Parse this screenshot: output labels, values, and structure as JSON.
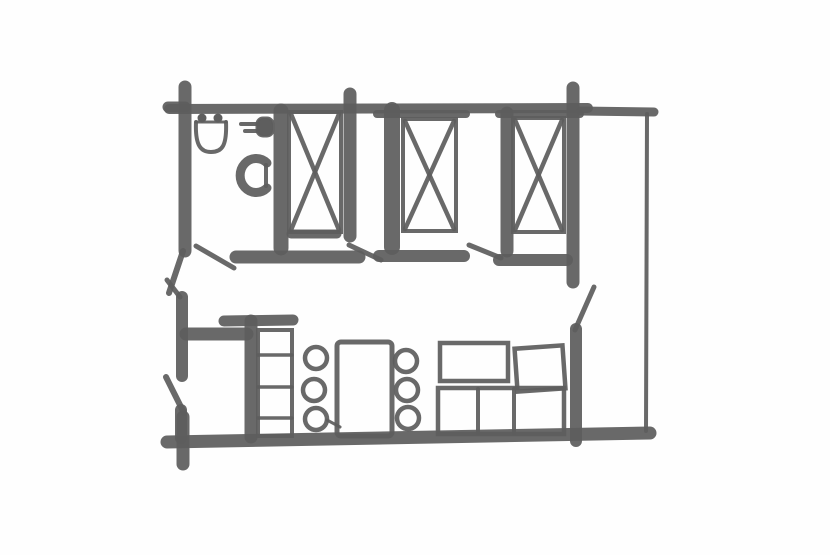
{
  "canvas": {
    "w": 830,
    "h": 555,
    "bg": "#fefefe",
    "ink": "#5e5e5e"
  },
  "floorplan": {
    "kind": "hand-drawn-floor-plan-sketch",
    "shapes": [
      {
        "name": "top-wall",
        "type": "line",
        "x1": 169,
        "y1": 109,
        "x2": 588,
        "y2": 108,
        "sw": 10
      },
      {
        "name": "top-wall-right",
        "type": "line",
        "x1": 580,
        "y1": 111,
        "x2": 654,
        "y2": 112,
        "sw": 9
      },
      {
        "name": "top-wall-cap-room2",
        "type": "line",
        "x1": 377,
        "y1": 114,
        "x2": 466,
        "y2": 114,
        "sw": 8
      },
      {
        "name": "top-wall-cap-room3",
        "type": "line",
        "x1": 499,
        "y1": 114,
        "x2": 580,
        "y2": 114,
        "sw": 8
      },
      {
        "name": "left-wall-upper",
        "type": "line",
        "x1": 185,
        "y1": 87,
        "x2": 185,
        "y2": 251,
        "sw": 13
      },
      {
        "name": "left-wall-top-arm",
        "type": "line",
        "x1": 168,
        "y1": 107,
        "x2": 185,
        "y2": 107,
        "sw": 11
      },
      {
        "name": "left-wall-taper",
        "type": "line",
        "x1": 183,
        "y1": 251,
        "x2": 169,
        "y2": 293,
        "sw": 6
      },
      {
        "name": "bathroom-right-wall",
        "type": "line",
        "x1": 281,
        "y1": 111,
        "x2": 281,
        "y2": 248,
        "sw": 15
      },
      {
        "name": "corridor-wall-a",
        "type": "line",
        "x1": 236,
        "y1": 257,
        "x2": 359,
        "y2": 257,
        "sw": 13
      },
      {
        "name": "room1-right-wall",
        "type": "line",
        "x1": 350,
        "y1": 94,
        "x2": 350,
        "y2": 236,
        "sw": 13
      },
      {
        "name": "bed1-foot-bar",
        "type": "line",
        "x1": 291,
        "y1": 234,
        "x2": 337,
        "y2": 234,
        "sw": 9
      },
      {
        "name": "room2-left-wall",
        "type": "line",
        "x1": 392,
        "y1": 110,
        "x2": 392,
        "y2": 247,
        "sw": 16
      },
      {
        "name": "corridor-wall-b",
        "type": "line",
        "x1": 379,
        "y1": 256,
        "x2": 464,
        "y2": 256,
        "sw": 12
      },
      {
        "name": "room3-left-wall",
        "type": "line",
        "x1": 507,
        "y1": 113,
        "x2": 507,
        "y2": 251,
        "sw": 13
      },
      {
        "name": "corridor-wall-c",
        "type": "line",
        "x1": 499,
        "y1": 260,
        "x2": 567,
        "y2": 260,
        "sw": 12
      },
      {
        "name": "room3-right-wall",
        "type": "line",
        "x1": 573,
        "y1": 88,
        "x2": 573,
        "y2": 282,
        "sw": 13
      },
      {
        "name": "living-right-wall",
        "type": "line",
        "x1": 576,
        "y1": 329,
        "x2": 576,
        "y2": 441,
        "sw": 12
      },
      {
        "name": "bottom-wall",
        "type": "line",
        "x1": 167,
        "y1": 442,
        "x2": 650,
        "y2": 433,
        "sw": 13
      },
      {
        "name": "bottom-left-stub",
        "type": "line",
        "x1": 183,
        "y1": 417,
        "x2": 183,
        "y2": 464,
        "sw": 13
      },
      {
        "name": "left-wall-lower",
        "type": "line",
        "x1": 182,
        "y1": 297,
        "x2": 182,
        "y2": 376,
        "sw": 12
      },
      {
        "name": "left-wall-lower-2",
        "type": "line",
        "x1": 181,
        "y1": 410,
        "x2": 181,
        "y2": 438,
        "sw": 12
      },
      {
        "name": "entry-wall",
        "type": "line",
        "x1": 186,
        "y1": 334,
        "x2": 247,
        "y2": 334,
        "sw": 13
      },
      {
        "name": "kitchen-cap-wall",
        "type": "line",
        "x1": 224,
        "y1": 321,
        "x2": 293,
        "y2": 320,
        "sw": 11
      },
      {
        "name": "kitchen-wall-stub",
        "type": "line",
        "x1": 251,
        "y1": 321,
        "x2": 251,
        "y2": 437,
        "sw": 13
      },
      {
        "name": "right-outer-wall",
        "type": "line",
        "x1": 647,
        "y1": 114,
        "x2": 646,
        "y2": 431,
        "sw": 4
      },
      {
        "name": "door-swing-bathroom",
        "type": "line",
        "x1": 196,
        "y1": 246,
        "x2": 234,
        "y2": 268,
        "sw": 5
      },
      {
        "name": "door-swing-room2",
        "type": "line",
        "x1": 349,
        "y1": 245,
        "x2": 381,
        "y2": 260,
        "sw": 5
      },
      {
        "name": "door-swing-room3",
        "type": "line",
        "x1": 469,
        "y1": 245,
        "x2": 501,
        "y2": 258,
        "sw": 5
      },
      {
        "name": "door-swing-living",
        "type": "line",
        "x1": 594,
        "y1": 287,
        "x2": 575,
        "y2": 330,
        "sw": 5
      },
      {
        "name": "door-swing-left-upper",
        "type": "line",
        "x1": 167,
        "y1": 280,
        "x2": 180,
        "y2": 297,
        "sw": 5
      },
      {
        "name": "door-swing-entry",
        "type": "line",
        "x1": 166,
        "y1": 377,
        "x2": 184,
        "y2": 413,
        "sw": 6
      },
      {
        "name": "bed-1-outline",
        "type": "rect",
        "x": 289,
        "y": 112,
        "wd": 52,
        "ht": 120,
        "sw": 4
      },
      {
        "name": "bed-1-cross-a",
        "type": "line",
        "x1": 291,
        "y1": 114,
        "x2": 339,
        "y2": 230,
        "sw": 4.5
      },
      {
        "name": "bed-1-cross-b",
        "type": "line",
        "x1": 339,
        "y1": 114,
        "x2": 291,
        "y2": 230,
        "sw": 4.5
      },
      {
        "name": "bed-2-outline",
        "type": "rect",
        "x": 403,
        "y": 119,
        "wd": 53,
        "ht": 112,
        "sw": 4
      },
      {
        "name": "bed-2-cross-a",
        "type": "line",
        "x1": 405,
        "y1": 121,
        "x2": 454,
        "y2": 229,
        "sw": 4.5
      },
      {
        "name": "bed-2-cross-b",
        "type": "line",
        "x1": 454,
        "y1": 121,
        "x2": 405,
        "y2": 229,
        "sw": 4.5
      },
      {
        "name": "bed-3-outline",
        "type": "rect",
        "x": 513,
        "y": 118,
        "wd": 51,
        "ht": 114,
        "sw": 4
      },
      {
        "name": "bed-3-cross-a",
        "type": "line",
        "x1": 515,
        "y1": 120,
        "x2": 562,
        "y2": 230,
        "sw": 4.5
      },
      {
        "name": "bed-3-cross-b",
        "type": "line",
        "x1": 562,
        "y1": 120,
        "x2": 515,
        "y2": 230,
        "sw": 4.5
      },
      {
        "name": "sink-bowl",
        "type": "path",
        "d": "M 196 122 C 195 146 201 152 211 152 C 222 152 227 146 226 122",
        "sw": 4
      },
      {
        "name": "sink-rim",
        "type": "line",
        "x1": 196,
        "y1": 122,
        "x2": 226,
        "y2": 122,
        "sw": 3
      },
      {
        "name": "sink-tap-dot-left",
        "type": "circle",
        "cx": 202,
        "cy": 118,
        "r": 4.5,
        "sw": 0,
        "fill": true
      },
      {
        "name": "sink-tap-dot-right",
        "type": "circle",
        "cx": 218,
        "cy": 118,
        "r": 4.5,
        "sw": 0,
        "fill": true
      },
      {
        "name": "wall-tap-body",
        "type": "rect",
        "x": 257,
        "y": 118,
        "wd": 16,
        "ht": 18,
        "rx": 6,
        "sw": 3,
        "fill": true
      },
      {
        "name": "wall-tap-spout-a",
        "type": "line",
        "x1": 241,
        "y1": 124,
        "x2": 258,
        "y2": 124,
        "sw": 4
      },
      {
        "name": "wall-tap-spout-b",
        "type": "line",
        "x1": 245,
        "y1": 131,
        "x2": 258,
        "y2": 131,
        "sw": 4
      },
      {
        "name": "toilet-bowl",
        "type": "path",
        "d": "M 267 163 A 16 17 0 1 0 267 188",
        "sw": 9
      },
      {
        "name": "toilet-seat-bar",
        "type": "line",
        "x1": 266,
        "y1": 165,
        "x2": 266,
        "y2": 186,
        "sw": 4
      },
      {
        "name": "kitchen-counter",
        "type": "rect",
        "x": 258,
        "y": 330,
        "wd": 34,
        "ht": 106,
        "sw": 4
      },
      {
        "name": "kitchen-counter-shelf-1",
        "type": "line",
        "x1": 258,
        "y1": 355,
        "x2": 292,
        "y2": 355,
        "sw": 3.5
      },
      {
        "name": "kitchen-counter-shelf-2",
        "type": "line",
        "x1": 258,
        "y1": 387,
        "x2": 292,
        "y2": 387,
        "sw": 3.5
      },
      {
        "name": "kitchen-counter-shelf-3",
        "type": "line",
        "x1": 258,
        "y1": 418,
        "x2": 292,
        "y2": 418,
        "sw": 3.5
      },
      {
        "name": "dining-table",
        "type": "rect",
        "x": 337,
        "y": 342,
        "wd": 55,
        "ht": 94,
        "rx": 4,
        "sw": 5
      },
      {
        "name": "chair-left-1",
        "type": "circle",
        "cx": 316,
        "cy": 358,
        "r": 11,
        "sw": 4.5
      },
      {
        "name": "chair-left-2",
        "type": "circle",
        "cx": 314,
        "cy": 390,
        "r": 11,
        "sw": 4.5
      },
      {
        "name": "chair-left-3",
        "type": "circle",
        "cx": 316,
        "cy": 419,
        "r": 11,
        "sw": 4.5
      },
      {
        "name": "chair-right-1",
        "type": "circle",
        "cx": 406,
        "cy": 361,
        "r": 11,
        "sw": 4.5
      },
      {
        "name": "chair-right-2",
        "type": "circle",
        "cx": 407,
        "cy": 390,
        "r": 11,
        "sw": 4.5
      },
      {
        "name": "chair-right-3",
        "type": "circle",
        "cx": 408,
        "cy": 418,
        "r": 11,
        "sw": 4.5
      },
      {
        "name": "chair-table-link",
        "type": "line",
        "x1": 327,
        "y1": 420,
        "x2": 340,
        "y2": 427,
        "sw": 3
      },
      {
        "name": "sofa-back-cushion-left",
        "type": "rect",
        "x": 440,
        "y": 343,
        "wd": 68,
        "ht": 38,
        "sw": 4.5
      },
      {
        "name": "sofa-back-cushion-right",
        "type": "rect",
        "x": 516,
        "y": 347,
        "wd": 48,
        "ht": 43,
        "sw": 4.5,
        "rot": -4
      },
      {
        "name": "sofa-seat",
        "type": "rect",
        "x": 438,
        "y": 388,
        "wd": 126,
        "ht": 46,
        "sw": 4.5
      },
      {
        "name": "sofa-seat-divider-1",
        "type": "line",
        "x1": 478,
        "y1": 389,
        "x2": 478,
        "y2": 433,
        "sw": 4
      },
      {
        "name": "sofa-seat-divider-2",
        "type": "line",
        "x1": 514,
        "y1": 389,
        "x2": 514,
        "y2": 433,
        "sw": 4
      }
    ]
  }
}
